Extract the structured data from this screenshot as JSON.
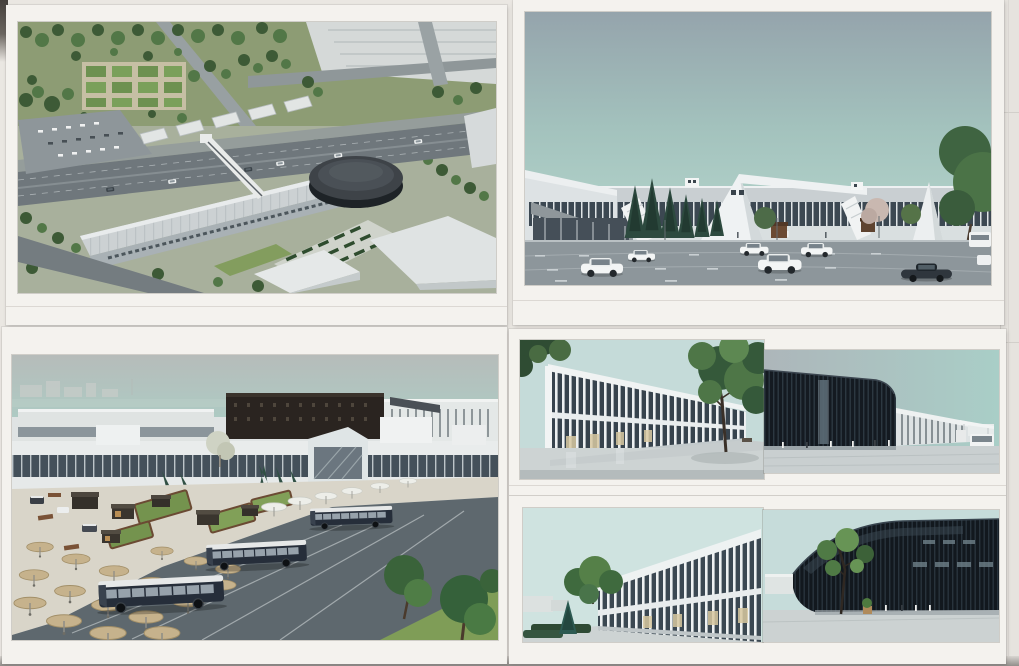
{
  "photo": {
    "description": "Photograph of four printed architectural renderings of a new transit terminal complex, mounted as white sheets in a two-by-two grid",
    "backdrop_color": "#eae7e2",
    "paper_color": "#f4f2ee"
  },
  "panels": [
    {
      "id": "aerial-masterplan",
      "label": "Aerial masterplan view: long terminal building with dark oval hall, pedestrian footbridge over the avenue, formal garden, parking lots and tree-lined streets"
    },
    {
      "id": "street-elevation",
      "label": "Street-level view: long low white terminal with continuous glass band, wedge-shaped entrance, evergreen trees and a car park with white SUVs and a dark sports car"
    },
    {
      "id": "bus-apron",
      "label": "Elevated view of the bus apron: three dark coaches with white roofs, rows of round tan shade umbrellas, garden plots, dark kiosks and white terminal buildings"
    },
    {
      "id": "facade-studies",
      "label": "Four facade studies: white colonnade halls beside dark vertically-louvered pavilions",
      "images": [
        {
          "id": "white-colonnade-day",
          "label": "White colonnade building with large tree"
        },
        {
          "id": "dark-louver-street",
          "label": "Dark louvered pavilion with colonnade wing, canopy and white van"
        },
        {
          "id": "white-colonnade-spruce",
          "label": "White colonnade building with blue spruce and hedge"
        },
        {
          "id": "dark-louver-curved",
          "label": "Curved dark louvered hall with young tree"
        }
      ]
    }
  ],
  "palette": {
    "sky_teal": "#a9cdc6",
    "sky_gray": "#97a6ae",
    "building_white": "#eceff0",
    "glass_dark": "#3c4852",
    "louver_black": "#161c22",
    "asphalt": "#5e686e",
    "umbrella_tan": "#c6b28c",
    "tree_green": "#3f6441",
    "bus_navy": "#262e3a",
    "lawn_green": "#7f9d57"
  }
}
